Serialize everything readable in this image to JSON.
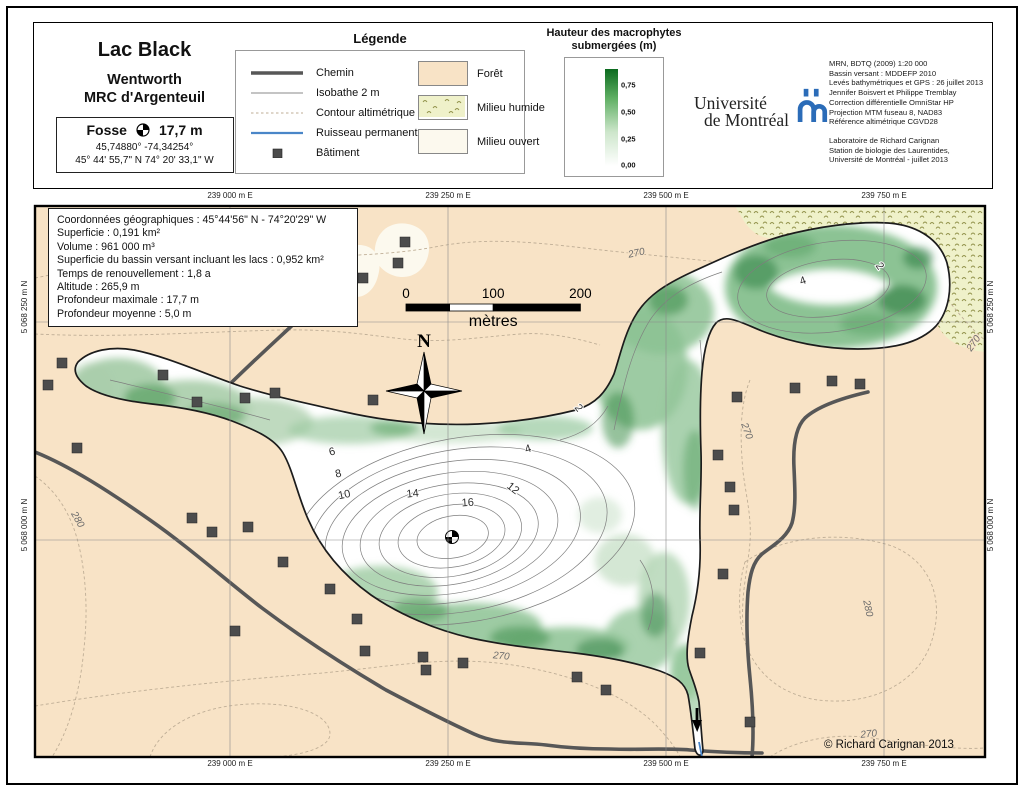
{
  "header": {
    "title_block": {
      "lake_name": "Lac Black",
      "municipality": "Wentworth",
      "mrc": "MRC d'Argenteuil",
      "fosse_label": "Fosse",
      "fosse_value": "17,7 m",
      "coords_decimal": "45,74880°   -74,34254°",
      "coords_dms": "45° 44' 55,7\" N  74° 20' 33,1\" W"
    },
    "legend": {
      "title": "Légende",
      "line_items": [
        {
          "type": "road",
          "label": "Chemin"
        },
        {
          "type": "isobath",
          "label": "Isobathe 2 m"
        },
        {
          "type": "contour",
          "label": "Contour altimétrique"
        },
        {
          "type": "stream",
          "label": "Ruisseau permanent"
        },
        {
          "type": "building",
          "label": "Bâtiment"
        }
      ],
      "area_items": [
        {
          "type": "forest",
          "label": "Forêt"
        },
        {
          "type": "wetland",
          "label": "Milieu humide"
        },
        {
          "type": "open",
          "label": "Milieu ouvert"
        }
      ]
    },
    "macro_scale": {
      "title_line1": "Hauteur des macrophytes",
      "title_line2": "submergées (m)",
      "ticks": [
        {
          "label": "0,75",
          "pos": 0.16
        },
        {
          "label": "0,50",
          "pos": 0.44
        },
        {
          "label": "0,25",
          "pos": 0.72
        },
        {
          "label": "0,00",
          "pos": 0.985
        }
      ]
    },
    "university": {
      "line1": "Université",
      "line2": "de Montréal"
    },
    "credits": {
      "source_lines": [
        "MRN, BDTQ (2009) 1:20 000",
        "Bassin versant : MDDEFP 2010",
        "Levés bathymétriques et GPS : 26 juillet 2013",
        "Jennifer Boisvert et Philippe Tremblay",
        "Correction différentielle OmniStar HP",
        "Projection MTM fuseau 8, NAD83",
        "Référence altimétrique CGVD28"
      ],
      "lab_lines": [
        "Laboratoire de Richard Carignan",
        "Station de biologie des Laurentides,",
        "Université de Montréal - juillet 2013"
      ]
    }
  },
  "map": {
    "info_box_lines": [
      "Coordonnées géographiques : 45°44'56\" N - 74°20'29\" W",
      "Superficie : 0,191 km²",
      "Volume : 961 000 m³",
      "Superficie du bassin versant incluant les lacs : 0,952 km²",
      "Temps de renouvellement : 1,8 a",
      "Altitude : 265,9 m",
      "Profondeur maximale : 17,7 m",
      "Profondeur moyenne :  5,0 m"
    ],
    "grid": {
      "eastings": [
        {
          "label": "239 000 m E",
          "x": 230
        },
        {
          "label": "239 250 m E",
          "x": 448
        },
        {
          "label": "239 500 m E",
          "x": 666
        },
        {
          "label": "239 750 m E",
          "x": 884
        }
      ],
      "northings": [
        {
          "label": "5 068 250 m N",
          "y": 322
        },
        {
          "label": "5 068 000 m N",
          "y": 540
        }
      ]
    },
    "scale_bar": {
      "ticks": [
        {
          "label": "0",
          "m": 0
        },
        {
          "label": "100",
          "m": 100
        },
        {
          "label": "200",
          "m": 200
        }
      ],
      "segments": [
        {
          "from": 0,
          "to": 50,
          "fill": "#000000"
        },
        {
          "from": 50,
          "to": 100,
          "fill": "#ffffff"
        },
        {
          "from": 100,
          "to": 200,
          "fill": "#000000"
        }
      ],
      "unit": "mètres"
    },
    "north_label": "N",
    "copyright": "© Richard Carignan 2013",
    "depth_labels": [
      {
        "t": "6",
        "x": 333,
        "y": 455,
        "r": -15
      },
      {
        "t": "8",
        "x": 339,
        "y": 477,
        "r": -12
      },
      {
        "t": "10",
        "x": 345,
        "y": 498,
        "r": -12
      },
      {
        "t": "14",
        "x": 413,
        "y": 497,
        "r": -6
      },
      {
        "t": "16",
        "x": 468,
        "y": 506,
        "r": -4
      },
      {
        "t": "12",
        "x": 511,
        "y": 491,
        "r": 38
      },
      {
        "t": "4",
        "x": 529,
        "y": 452,
        "r": -18
      },
      {
        "t": "2",
        "x": 576,
        "y": 410,
        "r": 52
      },
      {
        "t": "4",
        "x": 804,
        "y": 284,
        "r": -20
      },
      {
        "t": "2",
        "x": 877,
        "y": 268,
        "r": 55
      }
    ],
    "contour_labels": [
      {
        "t": "270",
        "x": 637,
        "y": 256,
        "r": -12
      },
      {
        "t": "270",
        "x": 976,
        "y": 345,
        "r": -55
      },
      {
        "t": "280",
        "x": 75,
        "y": 521,
        "r": 60
      },
      {
        "t": "270",
        "x": 744,
        "y": 432,
        "r": 70
      },
      {
        "t": "280",
        "x": 865,
        "y": 609,
        "r": 78
      },
      {
        "t": "270",
        "x": 501,
        "y": 659,
        "r": 5
      },
      {
        "t": "270",
        "x": 869,
        "y": 737,
        "r": -6
      }
    ],
    "isobaths": {
      "main": [
        {
          "depth": 2,
          "cx": 465,
          "cy": 532,
          "rx": 172,
          "ry": 92
        },
        {
          "depth": 4,
          "cx": 459,
          "cy": 532,
          "rx": 150,
          "ry": 81
        },
        {
          "depth": 6,
          "cx": 453,
          "cy": 532,
          "rx": 129,
          "ry": 70
        },
        {
          "depth": 8,
          "cx": 450,
          "cy": 533,
          "rx": 109,
          "ry": 60
        },
        {
          "depth": 10,
          "cx": 449,
          "cy": 534,
          "rx": 90,
          "ry": 50
        },
        {
          "depth": 12,
          "cx": 450,
          "cy": 535,
          "rx": 72,
          "ry": 41
        },
        {
          "depth": 14,
          "cx": 451,
          "cy": 536,
          "rx": 54,
          "ry": 31
        },
        {
          "depth": 16,
          "cx": 452,
          "cy": 537,
          "rx": 36,
          "ry": 21
        }
      ],
      "northeast": [
        {
          "depth": 2,
          "cx": 832,
          "cy": 287,
          "rx": 95,
          "ry": 45
        },
        {
          "depth": 4,
          "cx": 828,
          "cy": 288,
          "rx": 62,
          "ry": 28
        }
      ]
    },
    "buildings": [
      [
        62,
        363
      ],
      [
        48,
        385
      ],
      [
        77,
        448
      ],
      [
        163,
        375
      ],
      [
        197,
        402
      ],
      [
        245,
        398
      ],
      [
        275,
        393
      ],
      [
        373,
        400
      ],
      [
        405,
        242
      ],
      [
        398,
        263
      ],
      [
        363,
        278
      ],
      [
        192,
        518
      ],
      [
        212,
        532
      ],
      [
        248,
        527
      ],
      [
        283,
        562
      ],
      [
        330,
        589
      ],
      [
        235,
        631
      ],
      [
        357,
        619
      ],
      [
        365,
        651
      ],
      [
        423,
        657
      ],
      [
        463,
        663
      ],
      [
        426,
        670
      ],
      [
        577,
        677
      ],
      [
        606,
        690
      ],
      [
        737,
        397
      ],
      [
        795,
        388
      ],
      [
        832,
        381
      ],
      [
        860,
        384
      ],
      [
        718,
        455
      ],
      [
        730,
        487
      ],
      [
        734,
        510
      ],
      [
        723,
        574
      ],
      [
        700,
        653
      ],
      [
        750,
        722
      ]
    ],
    "colors": {
      "forest": "#f8e3c6",
      "wetland": "#eff1ca",
      "open": "#fcf9ee",
      "road": "#575757",
      "stream": "#4a86c8",
      "shore": "#1c1c1c",
      "macrophyte_dark": "#0c6b1f",
      "udem_blue": "#2b6cb8"
    }
  }
}
